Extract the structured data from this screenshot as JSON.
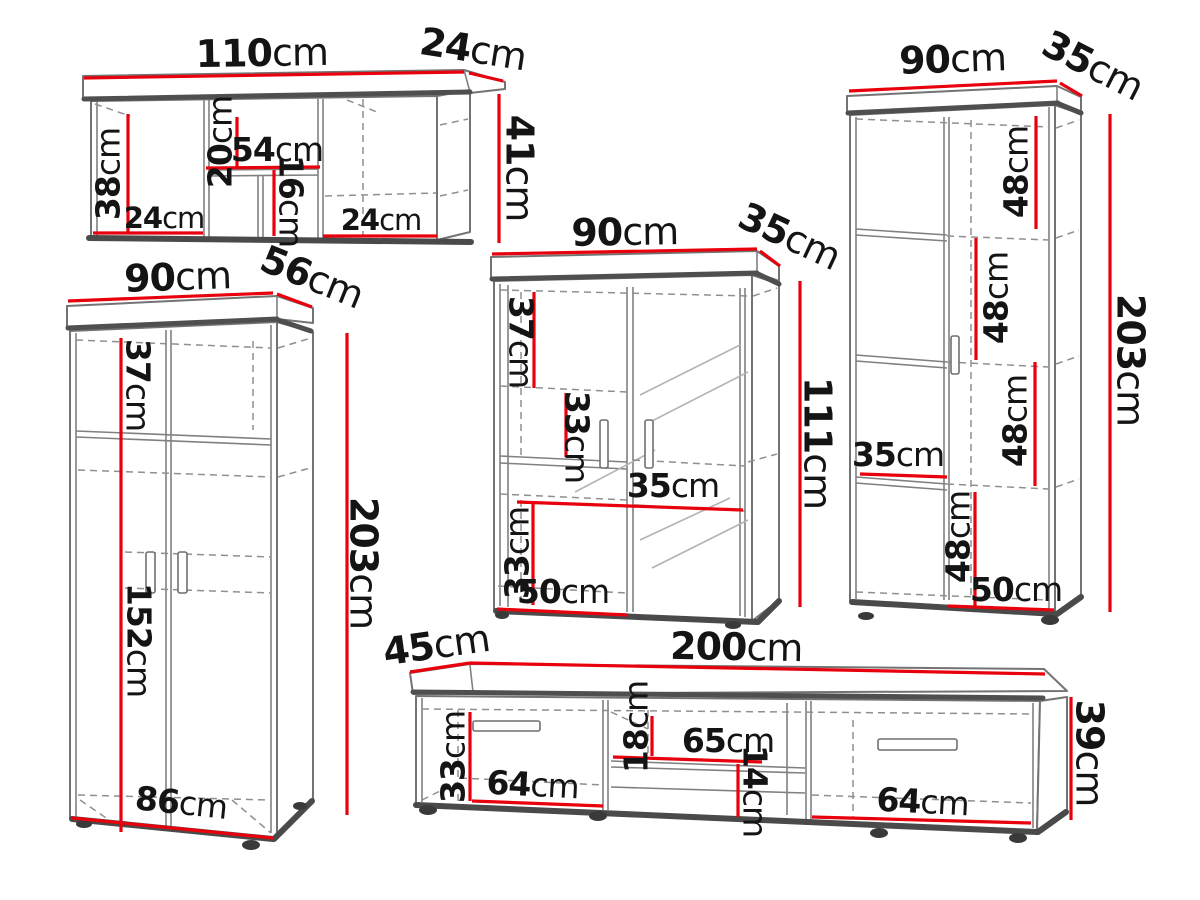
{
  "colors": {
    "dimension_red": "#e8000d",
    "outline_gray": "#737373",
    "outline_dark": "#4f4f4f",
    "label_text": "#141414"
  },
  "pieces": {
    "wall_shelf": {
      "width": {
        "n": "110",
        "u": "cm"
      },
      "depth": {
        "n": "24",
        "u": "cm"
      },
      "height": {
        "n": "41",
        "u": "cm"
      },
      "side_inner_height": {
        "n": "38",
        "u": "cm"
      },
      "upper_gap": {
        "n": "20",
        "u": "cm"
      },
      "middle_shelf_width": {
        "n": "54",
        "u": "cm"
      },
      "lower_gap": {
        "n": "16",
        "u": "cm"
      },
      "bottom_left_width": {
        "n": "24",
        "u": "cm"
      },
      "bottom_right_width": {
        "n": "24",
        "u": "cm"
      }
    },
    "wardrobe": {
      "width": {
        "n": "90",
        "u": "cm"
      },
      "depth": {
        "n": "56",
        "u": "cm"
      },
      "height": {
        "n": "203",
        "u": "cm"
      },
      "top_section": {
        "n": "37",
        "u": "cm"
      },
      "lower_section": {
        "n": "152",
        "u": "cm"
      },
      "bottom_width": {
        "n": "86",
        "u": "cm"
      }
    },
    "display_cabinet": {
      "width": {
        "n": "90",
        "u": "cm"
      },
      "depth": {
        "n": "35",
        "u": "cm"
      },
      "height": {
        "n": "111",
        "u": "cm"
      },
      "top_section": {
        "n": "37",
        "u": "cm"
      },
      "middle_section": {
        "n": "33",
        "u": "cm"
      },
      "shelf_depth": {
        "n": "35",
        "u": "cm"
      },
      "bottom_section": {
        "n": "33",
        "u": "cm"
      },
      "bottom_width": {
        "n": "50",
        "u": "cm"
      }
    },
    "tall_cabinet": {
      "width": {
        "n": "90",
        "u": "cm"
      },
      "depth": {
        "n": "35",
        "u": "cm"
      },
      "height": {
        "n": "203",
        "u": "cm"
      },
      "section_1": {
        "n": "48",
        "u": "cm"
      },
      "section_2": {
        "n": "48",
        "u": "cm"
      },
      "section_3": {
        "n": "48",
        "u": "cm"
      },
      "shelf_depth": {
        "n": "35",
        "u": "cm"
      },
      "section_4": {
        "n": "48",
        "u": "cm"
      },
      "bottom_width": {
        "n": "50",
        "u": "cm"
      }
    },
    "tv_stand": {
      "depth": {
        "n": "45",
        "u": "cm"
      },
      "width": {
        "n": "200",
        "u": "cm"
      },
      "height": {
        "n": "39",
        "u": "cm"
      },
      "left_inner_height": {
        "n": "33",
        "u": "cm"
      },
      "left_width": {
        "n": "64",
        "u": "cm"
      },
      "niche_upper": {
        "n": "18",
        "u": "cm"
      },
      "niche_width": {
        "n": "65",
        "u": "cm"
      },
      "niche_lower": {
        "n": "14",
        "u": "cm"
      },
      "right_width": {
        "n": "64",
        "u": "cm"
      }
    }
  }
}
